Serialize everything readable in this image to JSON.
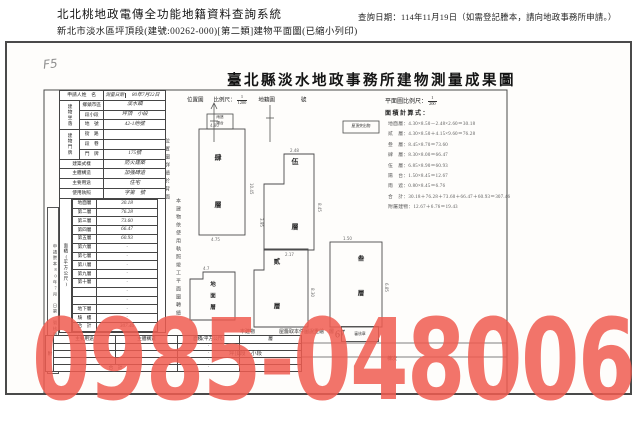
{
  "header": {
    "system_title": "北北桃地政電傳全功能地籍資料查詢系統",
    "query_date": "查詢日期：114年11月19日（如需登記謄本，請向地政事務所申請。）",
    "subtitle": "新北市淡水區坪頂段(建號:00262-000)[第二類]建物平面圖(已縮小列印)"
  },
  "scan": {
    "pencil_mark": "F5",
    "title": "臺北縣淡水地政事務所建物測量成果圖",
    "form": {
      "applicant_label": "申請人姓　名",
      "survey_date_label": "測量日期",
      "survey_date_value": "80年7月22日",
      "site_group": "建物坐落",
      "site_rows": [
        {
          "label": "鄉鎮市區",
          "value": "淡水鎮"
        },
        {
          "label": "段小段",
          "value": "坪頂　小段"
        },
        {
          "label": "地　號",
          "value": "42-1地號"
        }
      ],
      "door_group": "建物門牌",
      "door_rows": [
        {
          "label": "街　路",
          "value": "　"
        },
        {
          "label": "段　巷",
          "value": "　"
        },
        {
          "label": "門　牌",
          "value": "175號"
        }
      ],
      "attr_rows": [
        {
          "label": "建築式樣",
          "value": "防火建築"
        },
        {
          "label": "主體構造",
          "value": "加強磚造"
        },
        {
          "label": "主要用途",
          "value": "住宅"
        },
        {
          "label": "使用執照",
          "value": "字第　號"
        }
      ],
      "area_group": "面積(平方公尺)",
      "area_rows": [
        {
          "label": "地面層",
          "value": "30.18"
        },
        {
          "label": "第二層",
          "value": "76.28"
        },
        {
          "label": "第三層",
          "value": "73.60"
        },
        {
          "label": "第四層",
          "value": "66.47"
        },
        {
          "label": "第五層",
          "value": "60.93"
        },
        {
          "label": "第六層",
          "value": "·"
        },
        {
          "label": "第七層",
          "value": "·"
        },
        {
          "label": "第八層",
          "value": "·"
        },
        {
          "label": "第九層",
          "value": "·"
        },
        {
          "label": "第十層",
          "value": "·"
        },
        {
          "label": "　",
          "value": "·"
        },
        {
          "label": "　",
          "value": "·"
        },
        {
          "label": "地下層",
          "value": "·"
        },
        {
          "label": "騎　樓",
          "value": "·"
        },
        {
          "label": "合　計",
          "value": "307.46"
        }
      ],
      "transcript_strip": "申請謄本80年7月　日第　號核發"
    },
    "notes": {
      "s1": "位置圖詳繪於背面",
      "s2": "本建物依使用執照竣工平面圖轉繪"
    },
    "location_map": {
      "label": "位置圖",
      "scale_label": "比例尺：",
      "num": "1",
      "den": "1200",
      "map": "地籍圖",
      "no": "號"
    },
    "plan": {
      "scale_label": "平面圖比例尺：",
      "num": "1",
      "den": "200",
      "calc_label": "面積計算式：",
      "lines": [
        {
          "t": "地面層：4.30×8.50－2.48×2.60＝30.18"
        },
        {
          "t": "貳　層：4.30×8.50＋4.15×9.60＝76.28"
        },
        {
          "t": "叁　層：8.45×8.70＝73.60"
        },
        {
          "t": "肆　層：8.30×8.00＝66.47"
        },
        {
          "t": "伍　層：6.85×8.90＝60.93"
        },
        {
          "t": "陽　台：1.50×8.45＝12.67"
        },
        {
          "t": "雨　遮：0.80×8.45＝6.76"
        },
        {
          "t": "合　計：30.18＋76.28＋73.60＋66.47＋60.93＝307.46"
        },
        {
          "t": "附屬建物：12.67＋6.76＝19.43"
        }
      ]
    },
    "drawings": {
      "floor4": "肆層",
      "floor5": "伍層",
      "floor2": "貳層",
      "floor3": "叁層",
      "floor1": "地面層",
      "roof_box": "屋頂突出物",
      "canopy_top": "雨遮",
      "canopy_bottom": "陽台",
      "dims": [
        "4.80",
        "10.45",
        "4.75",
        "2.48",
        "8.45",
        "3.95",
        "4.7",
        "8.30",
        "1.50",
        "6.85",
        "2.17"
      ],
      "handwritten_number": "67"
    },
    "footer": {
      "frag1": "本建物",
      "frag2": "屋簷取本件圖說重繪　層",
      "stamp": "審核章",
      "frag3": "坪頂段　小段",
      "frag4": "棟次"
    }
  },
  "watermark": {
    "text": "0985-048006",
    "color": "#f05c50"
  }
}
